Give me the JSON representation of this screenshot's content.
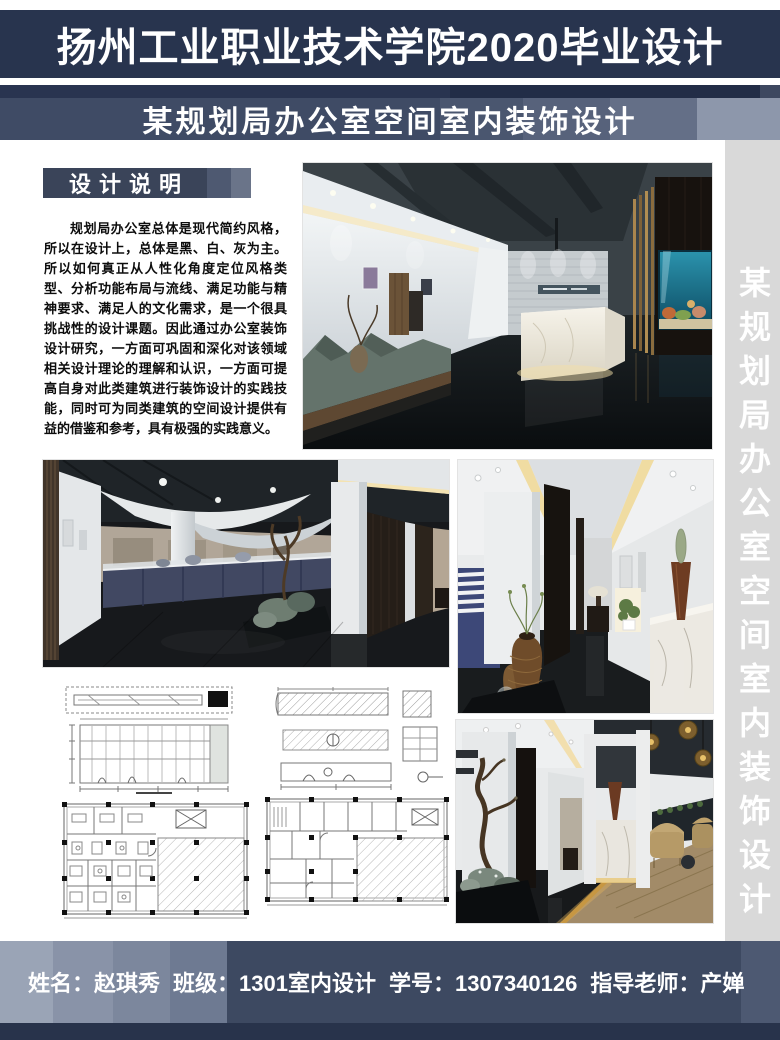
{
  "colors": {
    "header-navy": "#28344e",
    "strip-navy": "#222d47",
    "banner-navy": "#3f4b65",
    "badge-navy": "#3a4459",
    "footer-navy": "#3d4961",
    "bottom-navy": "#28334b",
    "sidebar-gray": "#d9d9d9",
    "text-dark": "#0d0d0d"
  },
  "header": {
    "title": "扬州工业职业技术学院2020毕业设计"
  },
  "banner": {
    "subtitle": "某规划局办公室空间室内装饰设计"
  },
  "design_note": {
    "heading": "设计说明",
    "body": "规划局办公室总体是现代简约风格，所以在设计上，总体是黑、白、灰为主。所以如何真正从人性化角度定位风格类型、分析功能布局与流线、满足功能与精神要求、满足人的文化需求，是一个很具挑战性的设计课题。因此通过办公室装饰设计研究，一方面可巩固和深化对该领域相关设计理论的理解和认识，一方面可提高自身对此类建筑进行装饰设计的实践技能，同时可为同类建筑的空间设计提供有益的借鉴和参考，具有极强的实践意义。"
  },
  "side_banner": {
    "vertical_text": "某规划局办公室空间室内装饰设计"
  },
  "footer": {
    "name_label": "姓名：",
    "name": "赵琪秀",
    "class_label": "班级：",
    "class_name": "1301室内设计",
    "student_no_label": "学号：",
    "student_no": "1307340126",
    "advisor_label": "指导老师：",
    "advisor": "产婵"
  }
}
